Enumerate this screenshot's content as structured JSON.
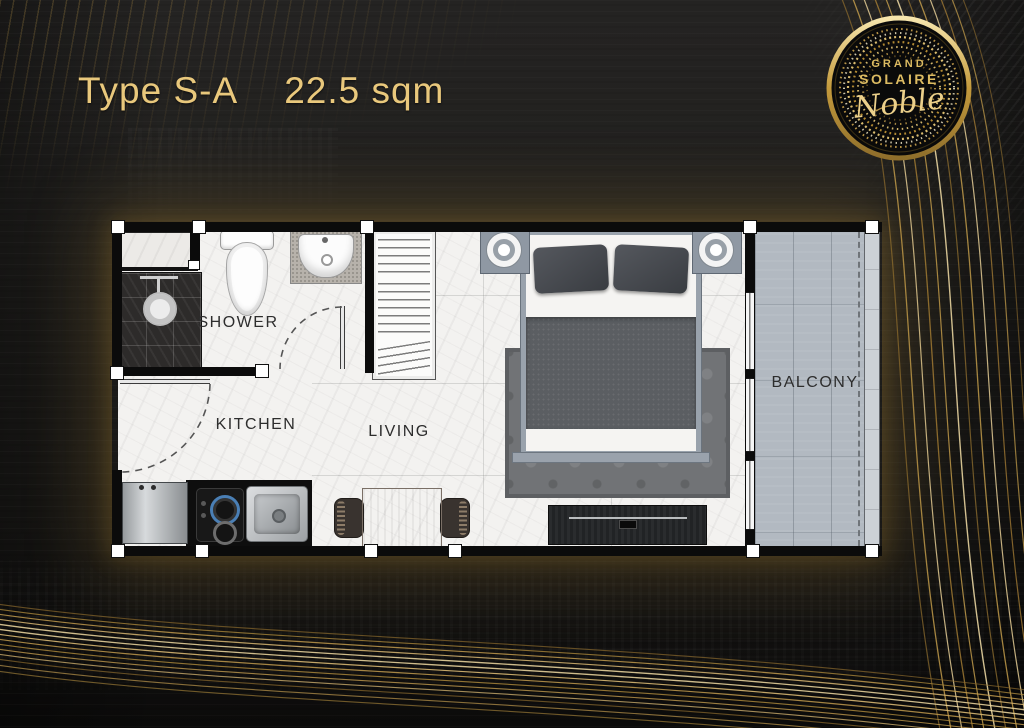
{
  "header": {
    "type": "Type S-A",
    "area": "22.5 sqm"
  },
  "logo": {
    "line1": "GRAND",
    "line2": "SOLAIRE",
    "script": "Noble"
  },
  "floorplan": {
    "rooms": [
      {
        "id": "shower",
        "label": "SHOWER"
      },
      {
        "id": "kitchen",
        "label": "KITCHEN"
      },
      {
        "id": "living",
        "label": "LIVING"
      },
      {
        "id": "balcony",
        "label": "BALCONY"
      }
    ],
    "furniture": [
      "bed",
      "bedside-tables",
      "wardrobe",
      "rug",
      "tv-console",
      "dining-table",
      "chairs",
      "refrigerator",
      "stove",
      "kitchen-sink",
      "toilet",
      "washbasin",
      "shower-head"
    ]
  },
  "colors": {
    "accent_gold": "#e9c87c",
    "plan_glow": "#aa8232",
    "background": "#1d1c1a",
    "logo_gold": "#dcbb62"
  }
}
